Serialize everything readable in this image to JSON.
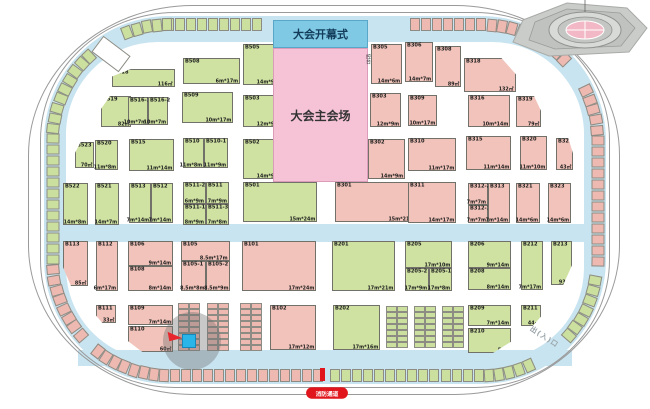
{
  "map": {
    "ceremony_label": "大会开幕式",
    "main_hall_label": "大会主会场",
    "control_label": "控台",
    "fire_lane_label": "消防通道",
    "exit_label": "出(入)口",
    "passage_label": "(消防通道)",
    "colors": {
      "walkway_blue": "#c8e4f0",
      "booth_green": "#cfe2a2",
      "booth_pink": "#f2c3ba",
      "ceremony_blue": "#7fc9e4",
      "main_hall_pink": "#f6c3d6",
      "alert_red": "#e0161c",
      "highlight_cyan": "#2ab5e8"
    },
    "booths": [
      {
        "id": "B518",
        "x": 112,
        "y": 69,
        "w": 63,
        "h": 18,
        "c": "g",
        "d": "116㎡",
        "s": "tl"
      },
      {
        "id": "B508",
        "x": 183,
        "y": 58,
        "w": 57,
        "h": 26,
        "c": "g",
        "d": "6m*17m"
      },
      {
        "id": "B505",
        "x": 243,
        "y": 44,
        "w": 38,
        "h": 41,
        "c": "g",
        "d": "14m*9m"
      },
      {
        "id": "B519",
        "x": 101,
        "y": 96,
        "w": 30,
        "h": 31,
        "c": "g",
        "d": "82㎡",
        "s": "tl"
      },
      {
        "id": "B516-1",
        "x": 128,
        "y": 97,
        "w": 20,
        "h": 28,
        "c": "g",
        "d": "10m*7m"
      },
      {
        "id": "B516-2",
        "x": 148,
        "y": 97,
        "w": 20,
        "h": 28,
        "c": "g",
        "d": "10m*7m"
      },
      {
        "id": "B509",
        "x": 182,
        "y": 92,
        "w": 51,
        "h": 31,
        "c": "g",
        "d": "10m*17m"
      },
      {
        "id": "B503",
        "x": 243,
        "y": 95,
        "w": 38,
        "h": 32,
        "c": "g",
        "d": "12m*9m"
      },
      {
        "id": "B523",
        "x": 75,
        "y": 142,
        "w": 19,
        "h": 26,
        "c": "g",
        "d": "70㎡",
        "s": "tl"
      },
      {
        "id": "B520",
        "x": 95,
        "y": 140,
        "w": 23,
        "h": 30,
        "c": "g",
        "d": "11m*8m"
      },
      {
        "id": "B515",
        "x": 129,
        "y": 139,
        "w": 45,
        "h": 32,
        "c": "g",
        "d": "11m*14m"
      },
      {
        "id": "B510",
        "x": 183,
        "y": 138,
        "w": 21,
        "h": 30,
        "c": "g",
        "d": "11m*8m"
      },
      {
        "id": "B510-1",
        "x": 204,
        "y": 138,
        "w": 24,
        "h": 30,
        "c": "g",
        "d": "11m*9m"
      },
      {
        "id": "B502",
        "x": 243,
        "y": 139,
        "w": 38,
        "h": 40,
        "c": "g",
        "d": "14m*9m"
      },
      {
        "id": "B522",
        "x": 63,
        "y": 183,
        "w": 25,
        "h": 42,
        "c": "g",
        "d": "14m*8m"
      },
      {
        "id": "B521",
        "x": 95,
        "y": 183,
        "w": 24,
        "h": 42,
        "c": "g",
        "d": "14m*7m"
      },
      {
        "id": "B513",
        "x": 129,
        "y": 183,
        "w": 22,
        "h": 40,
        "c": "g",
        "d": "7m*14m"
      },
      {
        "id": "B512",
        "x": 151,
        "y": 183,
        "w": 22,
        "h": 40,
        "c": "g",
        "d": "7m*14m"
      },
      {
        "id": "B511-2",
        "x": 183,
        "y": 182,
        "w": 23,
        "h": 22,
        "c": "g",
        "d": "6m*9m"
      },
      {
        "id": "B511",
        "x": 206,
        "y": 182,
        "w": 23,
        "h": 22,
        "c": "g",
        "d": "7m*9m"
      },
      {
        "id": "B511-1",
        "x": 183,
        "y": 204,
        "w": 23,
        "h": 21,
        "c": "g",
        "d": "8m*9m"
      },
      {
        "id": "B511-3",
        "x": 206,
        "y": 204,
        "w": 23,
        "h": 21,
        "c": "g",
        "d": "7m*8m"
      },
      {
        "id": "B501",
        "x": 243,
        "y": 182,
        "w": 74,
        "h": 40,
        "c": "g",
        "d": "15m*24m"
      },
      {
        "id": "B305",
        "x": 371,
        "y": 44,
        "w": 31,
        "h": 40,
        "c": "p",
        "d": "14m*6m"
      },
      {
        "id": "B306",
        "x": 405,
        "y": 42,
        "w": 28,
        "h": 40,
        "c": "p",
        "d": "14m*7m"
      },
      {
        "id": "B308",
        "x": 435,
        "y": 46,
        "w": 26,
        "h": 41,
        "c": "p",
        "d": "89㎡"
      },
      {
        "id": "B318",
        "x": 464,
        "y": 58,
        "w": 52,
        "h": 34,
        "c": "p",
        "d": "132㎡",
        "s": "tr"
      },
      {
        "id": "B303",
        "x": 370,
        "y": 93,
        "w": 31,
        "h": 34,
        "c": "p",
        "d": "12m*9m"
      },
      {
        "id": "B309",
        "x": 408,
        "y": 95,
        "w": 29,
        "h": 31,
        "c": "p",
        "d": "10m*17m"
      },
      {
        "id": "B316",
        "x": 468,
        "y": 95,
        "w": 42,
        "h": 32,
        "c": "p",
        "d": "10m*14m"
      },
      {
        "id": "B319",
        "x": 516,
        "y": 96,
        "w": 25,
        "h": 31,
        "c": "p",
        "d": "79㎡",
        "s": "tr"
      },
      {
        "id": "B302",
        "x": 368,
        "y": 139,
        "w": 37,
        "h": 40,
        "c": "p",
        "d": "14m*9m"
      },
      {
        "id": "B310",
        "x": 408,
        "y": 138,
        "w": 48,
        "h": 33,
        "c": "p",
        "d": "11m*17m"
      },
      {
        "id": "B315",
        "x": 466,
        "y": 136,
        "w": 45,
        "h": 34,
        "c": "p",
        "d": "11m*14m"
      },
      {
        "id": "B320",
        "x": 520,
        "y": 136,
        "w": 27,
        "h": 34,
        "c": "p",
        "d": "11m*10m"
      },
      {
        "id": "B322",
        "x": 556,
        "y": 138,
        "w": 17,
        "h": 32,
        "c": "p",
        "d": "43㎡",
        "s": "tr"
      },
      {
        "id": "B301",
        "x": 335,
        "y": 182,
        "w": 81,
        "h": 40,
        "c": "p",
        "d": "15m*21m"
      },
      {
        "id": "B311",
        "x": 408,
        "y": 182,
        "w": 48,
        "h": 41,
        "c": "p",
        "d": "14m*17m"
      },
      {
        "id": "B312-2",
        "x": 468,
        "y": 183,
        "w": 20,
        "h": 22,
        "c": "p",
        "d": "7m*7m"
      },
      {
        "id": "B312-1",
        "x": 468,
        "y": 205,
        "w": 20,
        "h": 18,
        "c": "p",
        "d": "7m*7m"
      },
      {
        "id": "B313",
        "x": 488,
        "y": 183,
        "w": 22,
        "h": 40,
        "c": "p",
        "d": "7m*14m"
      },
      {
        "id": "B321",
        "x": 516,
        "y": 183,
        "w": 24,
        "h": 40,
        "c": "p",
        "d": "14m*6m"
      },
      {
        "id": "B323",
        "x": 548,
        "y": 183,
        "w": 23,
        "h": 40,
        "c": "p",
        "d": "14m*6m"
      },
      {
        "id": "B113",
        "x": 63,
        "y": 241,
        "w": 25,
        "h": 45,
        "c": "p",
        "d": "85㎡",
        "s": "bl"
      },
      {
        "id": "B112",
        "x": 96,
        "y": 241,
        "w": 22,
        "h": 50,
        "c": "p",
        "d": "6m*17m"
      },
      {
        "id": "B106",
        "x": 128,
        "y": 241,
        "w": 45,
        "h": 25,
        "c": "p",
        "d": "9m*14m"
      },
      {
        "id": "B108",
        "x": 128,
        "y": 266,
        "w": 45,
        "h": 25,
        "c": "p",
        "d": "8m*14m"
      },
      {
        "id": "B105",
        "x": 181,
        "y": 241,
        "w": 49,
        "h": 20,
        "c": "p",
        "d": "8.5m*17m"
      },
      {
        "id": "B105-1",
        "x": 181,
        "y": 261,
        "w": 25,
        "h": 30,
        "c": "p",
        "d": "8.5m*8m"
      },
      {
        "id": "B105-2",
        "x": 206,
        "y": 261,
        "w": 24,
        "h": 30,
        "c": "p",
        "d": "8.5m*9m"
      },
      {
        "id": "B101",
        "x": 242,
        "y": 241,
        "w": 74,
        "h": 50,
        "c": "p",
        "d": "17m*24m"
      },
      {
        "id": "B111",
        "x": 96,
        "y": 305,
        "w": 20,
        "h": 18,
        "c": "p",
        "d": "33㎡",
        "s": "bl"
      },
      {
        "id": "B109",
        "x": 128,
        "y": 305,
        "w": 45,
        "h": 20,
        "c": "p",
        "d": "7m*14m"
      },
      {
        "id": "B110",
        "x": 128,
        "y": 326,
        "w": 45,
        "h": 26,
        "c": "p",
        "d": "60㎡",
        "s": "bl"
      },
      {
        "id": "B102",
        "x": 270,
        "y": 305,
        "w": 46,
        "h": 45,
        "c": "p",
        "d": "17m*12m"
      },
      {
        "id": "B201",
        "x": 332,
        "y": 241,
        "w": 63,
        "h": 50,
        "c": "g",
        "d": "17m*21m"
      },
      {
        "id": "B205",
        "x": 405,
        "y": 241,
        "w": 47,
        "h": 27,
        "c": "g",
        "d": "17m*10m"
      },
      {
        "id": "B205-2",
        "x": 405,
        "y": 268,
        "w": 24,
        "h": 23,
        "c": "g",
        "d": "17m*9m"
      },
      {
        "id": "B205-1",
        "x": 429,
        "y": 268,
        "w": 23,
        "h": 23,
        "c": "g",
        "d": "17m*8m"
      },
      {
        "id": "B206",
        "x": 468,
        "y": 241,
        "w": 43,
        "h": 27,
        "c": "g",
        "d": "9m*14m"
      },
      {
        "id": "B208",
        "x": 468,
        "y": 268,
        "w": 43,
        "h": 22,
        "c": "g",
        "d": "8m*14m"
      },
      {
        "id": "B212",
        "x": 521,
        "y": 241,
        "w": 22,
        "h": 49,
        "c": "g",
        "d": "7m*17m"
      },
      {
        "id": "B213",
        "x": 551,
        "y": 241,
        "w": 21,
        "h": 44,
        "c": "g",
        "d": "93㎡",
        "s": "br"
      },
      {
        "id": "B202",
        "x": 333,
        "y": 305,
        "w": 47,
        "h": 45,
        "c": "g",
        "d": "17m*16m"
      },
      {
        "id": "B209",
        "x": 468,
        "y": 305,
        "w": 43,
        "h": 21,
        "c": "g",
        "d": "7m*14m"
      },
      {
        "id": "B210",
        "x": 468,
        "y": 328,
        "w": 43,
        "h": 25,
        "c": "g",
        "d": "52㎡",
        "s": "br"
      },
      {
        "id": "B211",
        "x": 521,
        "y": 305,
        "w": 20,
        "h": 21,
        "c": "g",
        "d": "44㎡",
        "s": "br"
      }
    ],
    "stall_groups": [
      {
        "x": 178,
        "y": 303,
        "cols": 2,
        "rows": 8,
        "c": "p"
      },
      {
        "x": 207,
        "y": 303,
        "cols": 2,
        "rows": 8,
        "c": "p"
      },
      {
        "x": 240,
        "y": 303,
        "cols": 2,
        "rows": 8,
        "c": "p"
      },
      {
        "x": 386,
        "y": 306,
        "cols": 2,
        "rows": 7,
        "c": "g"
      },
      {
        "x": 414,
        "y": 306,
        "cols": 2,
        "rows": 7,
        "c": "g"
      },
      {
        "x": 442,
        "y": 306,
        "cols": 2,
        "rows": 7,
        "c": "g"
      }
    ]
  }
}
